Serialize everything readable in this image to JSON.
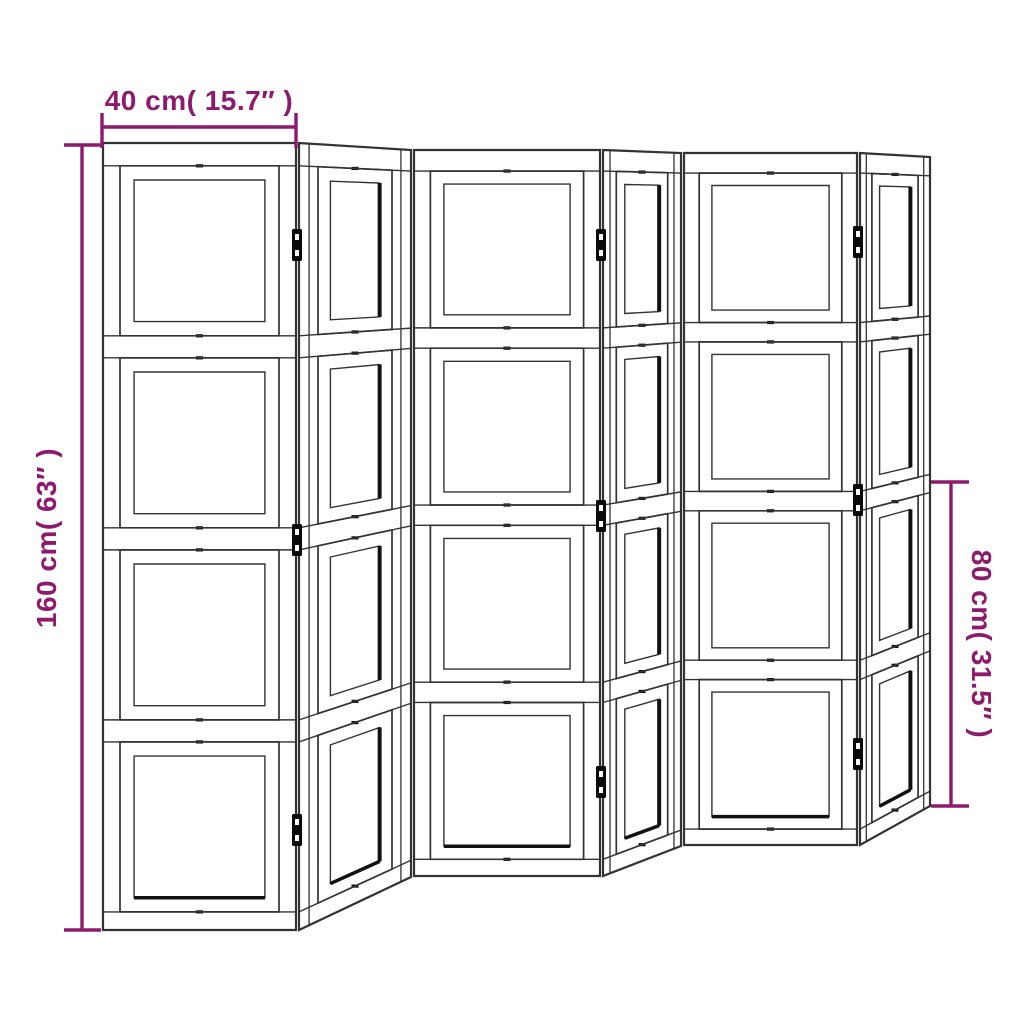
{
  "figure_type": "product-dimension-diagram",
  "subject": "6-panel folding room divider screen",
  "colors": {
    "background": "#ffffff",
    "line": "#333333",
    "line_heavy": "#111111",
    "hinge": "#0a0a0a",
    "accent": "#8D1A6D"
  },
  "dimensions": {
    "width": {
      "label": "40 cm( 15.7″ )",
      "line": {
        "x1": 102,
        "y1": 127,
        "x2": 296,
        "y2": 127
      },
      "ticks": [
        {
          "x1": 102,
          "y1": 113,
          "x2": 102,
          "y2": 148
        },
        {
          "x1": 296,
          "y1": 113,
          "x2": 296,
          "y2": 148
        }
      ]
    },
    "height": {
      "label": "160 cm( 63″ )",
      "line": {
        "x1": 82,
        "y1": 145,
        "x2": 82,
        "y2": 930
      },
      "ticks": [
        {
          "x1": 64,
          "y1": 145,
          "x2": 101,
          "y2": 145
        },
        {
          "x1": 64,
          "y1": 930,
          "x2": 101,
          "y2": 930
        }
      ]
    },
    "half_height": {
      "label": "80 cm( 31.5″ )",
      "line": {
        "x1": 951,
        "y1": 482,
        "x2": 951,
        "y2": 806
      },
      "ticks": [
        {
          "x1": 931,
          "y1": 482,
          "x2": 969,
          "y2": 482
        },
        {
          "x1": 931,
          "y1": 806,
          "x2": 969,
          "y2": 806
        }
      ]
    }
  },
  "screen": {
    "panel_count": 6,
    "cells_per_panel": 4,
    "panels": [
      {
        "name": "panel-1",
        "type": "front",
        "corners": [
          [
            103,
            143
          ],
          [
            296,
            143
          ],
          [
            296,
            930
          ],
          [
            103,
            930
          ]
        ]
      },
      {
        "name": "panel-2",
        "type": "angled",
        "corners": [
          [
            299,
            143
          ],
          [
            411,
            150
          ],
          [
            411,
            877
          ],
          [
            299,
            930
          ]
        ]
      },
      {
        "name": "panel-3",
        "type": "front",
        "corners": [
          [
            414,
            150
          ],
          [
            600,
            150
          ],
          [
            600,
            876
          ],
          [
            414,
            876
          ]
        ]
      },
      {
        "name": "panel-4",
        "type": "angled",
        "corners": [
          [
            603,
            150
          ],
          [
            681,
            153
          ],
          [
            681,
            846
          ],
          [
            603,
            876
          ]
        ]
      },
      {
        "name": "panel-5",
        "type": "front",
        "corners": [
          [
            684,
            153
          ],
          [
            857,
            153
          ],
          [
            857,
            845
          ],
          [
            684,
            845
          ]
        ]
      },
      {
        "name": "panel-6",
        "type": "angled",
        "corners": [
          [
            860,
            153
          ],
          [
            930,
            157
          ],
          [
            930,
            806
          ],
          [
            860,
            845
          ]
        ]
      }
    ],
    "structure": {
      "top_rail": 0.029,
      "cell": 0.216,
      "rail": 0.028,
      "bottom_line": 0.977,
      "side_inset_front": 0.088,
      "side_inset_angled": 0.17,
      "inner_u_front": 0.073,
      "inner_u_angled": 0.11,
      "inner_v": 0.018,
      "stile_line_u": 0.09
    },
    "hinges": [
      {
        "x": 297,
        "y": 245
      },
      {
        "x": 297,
        "y": 540
      },
      {
        "x": 297,
        "y": 830
      },
      {
        "x": 601,
        "y": 245
      },
      {
        "x": 601,
        "y": 516
      },
      {
        "x": 601,
        "y": 782
      },
      {
        "x": 858,
        "y": 242
      },
      {
        "x": 858,
        "y": 500
      },
      {
        "x": 858,
        "y": 754
      }
    ]
  }
}
